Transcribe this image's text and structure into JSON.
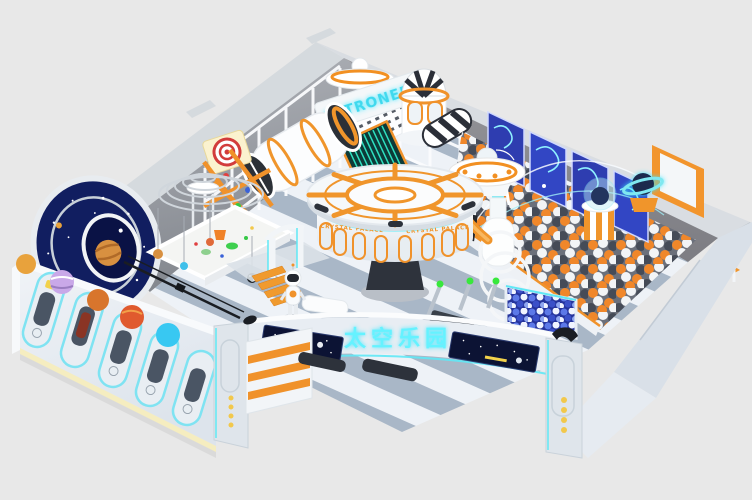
{
  "scene": {
    "alt": "Isometric 3D render of a space-themed indoor playground: cutaway room with gray walls, striped floor, ball pit, carousel, galaxy tunnel, slides and glowing neon signage",
    "background_color": "#e8e8e8"
  },
  "signs": {
    "astroneer": "ASTRONEER",
    "carousel": "CRYSTAL PALACE",
    "entrance": "太空乐园",
    "banner_left": "SPACE"
  },
  "palette": {
    "orange": "#f0922b",
    "cyan_glow": "#5fe8f5",
    "panel_blue": "#2e3db0",
    "space_navy": "#0c1334",
    "wall_gray": "#8f9298",
    "floor_stripe_blue": "#a9b7c7",
    "ball_orange": "#f0872a",
    "ball_dark": "#454b57",
    "ball_white": "#f2f4f6",
    "glow_yellow": "#f2c84b",
    "sand": "#f4f5f3"
  },
  "zones": [
    {
      "name": "galaxy-tunnel"
    },
    {
      "name": "spiral-ring-climber"
    },
    {
      "name": "sand-pit"
    },
    {
      "name": "rocket-tube-bridge"
    },
    {
      "name": "striped-dome-tower"
    },
    {
      "name": "ufo-saucer"
    },
    {
      "name": "crystal-palace-carousel"
    },
    {
      "name": "ball-pit"
    },
    {
      "name": "interactive-wall-panels"
    },
    {
      "name": "saturn-globe"
    },
    {
      "name": "observation-dome-table"
    },
    {
      "name": "entrance-gate"
    },
    {
      "name": "capsule-window-wall"
    },
    {
      "name": "planet-decorations"
    },
    {
      "name": "robot-mascot"
    },
    {
      "name": "shoe-shelf"
    },
    {
      "name": "benches"
    },
    {
      "name": "zipline"
    }
  ]
}
